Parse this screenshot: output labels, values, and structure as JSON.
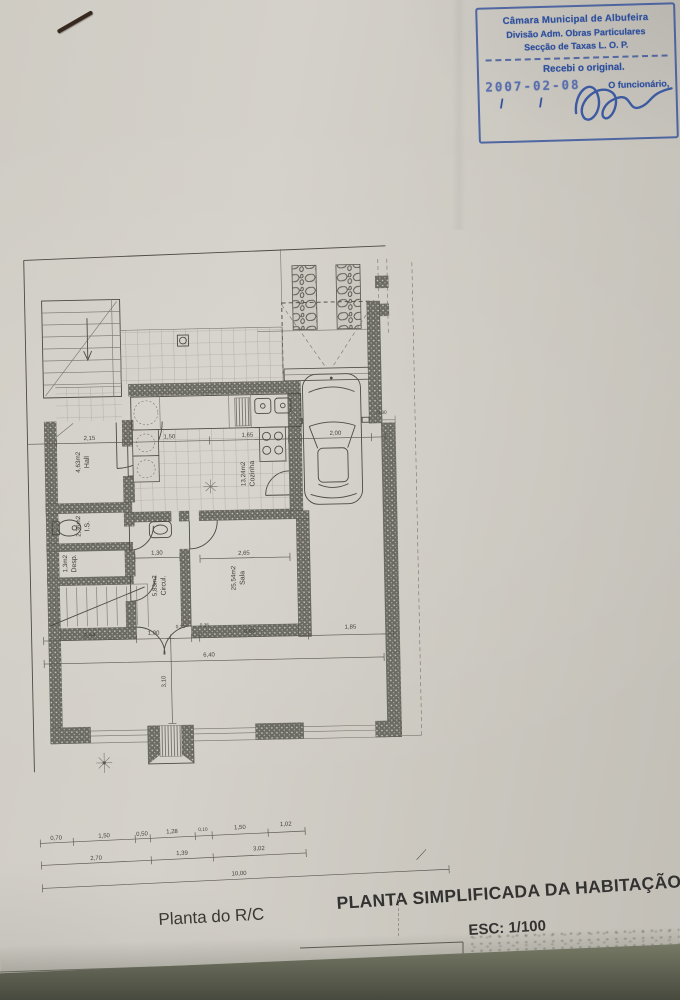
{
  "stamp": {
    "line1": "Câmara Municipal de Albufeira",
    "line2": "Divisão Adm. Obras Particulares",
    "line3": "Secção de Taxas L. O. P.",
    "received": "Recebi o original.",
    "date": "2007-02-08",
    "official": "O funcionário,",
    "slashes": "/  /",
    "accent_color": "#2d4f9e"
  },
  "titles": {
    "plan_label": "Planta do R/C",
    "main_title": "PLANTA SIMPLIFICADA DA HABITAÇÃO",
    "scale": "ESC: 1/100"
  },
  "plan": {
    "rooms": {
      "hall": {
        "area": "4,63m2",
        "name": "Hall"
      },
      "is": {
        "area": "2,36m2",
        "name": "I.S."
      },
      "desp": {
        "area": "1,3m2",
        "name": "Desp."
      },
      "circul": {
        "area": "5,83m2",
        "name": "Circul."
      },
      "cozinha": {
        "area": "13,24m2",
        "name": "Cozinha"
      },
      "sala": {
        "area": "25,54m2",
        "name": "Sala"
      }
    },
    "dims": {
      "main": [
        "2,15",
        "1,50",
        "1,65",
        "2,00"
      ],
      "circul_width": "1,30",
      "sala_width": "2,65",
      "wall": "0,30",
      "terrace": [
        "2,44",
        "1,00",
        "0,30",
        "0,80",
        "0,35",
        "1,85"
      ],
      "terrace_total": "6,40",
      "terrace_height": "3,10",
      "row1": [
        "0,70",
        "1,50",
        "0,50",
        "1,28",
        "0,10",
        "1,50",
        "1,02"
      ],
      "row2": [
        "2,70",
        "1,39",
        "3,02"
      ],
      "row3": [
        "10,00"
      ]
    }
  }
}
